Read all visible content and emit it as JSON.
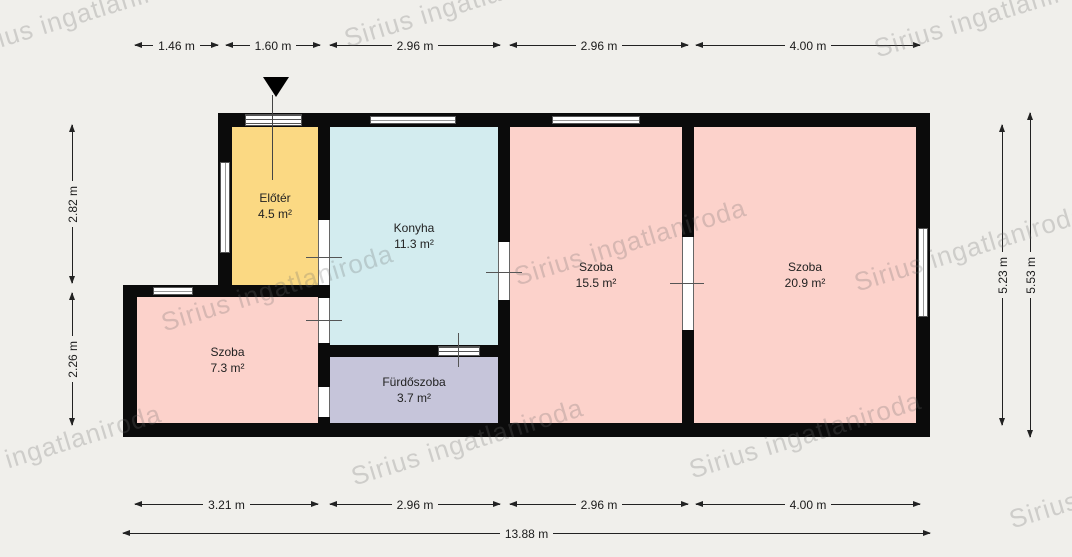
{
  "watermark": {
    "text": "Sirius ingatlaniroda"
  },
  "rooms": [
    {
      "name": "Előtér",
      "area": "4.5 m²",
      "color": "#fbd983"
    },
    {
      "name": "Konyha",
      "area": "11.3 m²",
      "color": "#d3ecef"
    },
    {
      "name": "Szoba",
      "area": "15.5 m²",
      "color": "#fcd2cb"
    },
    {
      "name": "Szoba",
      "area": "20.9 m²",
      "color": "#fcd2cb"
    },
    {
      "name": "Szoba",
      "area": "7.3 m²",
      "color": "#fcd2cb"
    },
    {
      "name": "Fürdőszoba",
      "area": "3.7 m²",
      "color": "#c6c5da"
    }
  ],
  "dimensions": {
    "top": [
      "1.46 m",
      "1.60 m",
      "2.96 m",
      "2.96 m",
      "4.00 m"
    ],
    "bottom": [
      "3.21 m",
      "2.96 m",
      "2.96 m",
      "4.00 m"
    ],
    "total_width": "13.88 m",
    "left": [
      "2.82 m",
      "2.26 m"
    ],
    "right_inner": "5.23 m",
    "right_outer": "5.53 m"
  },
  "colors": {
    "bg": "#f0efeb",
    "wall": "#0b0b0b",
    "dim": "#1a1a1a",
    "watermark": "rgba(110,110,110,0.26)",
    "opening": "#ffffff",
    "opening_line": "#666666"
  }
}
